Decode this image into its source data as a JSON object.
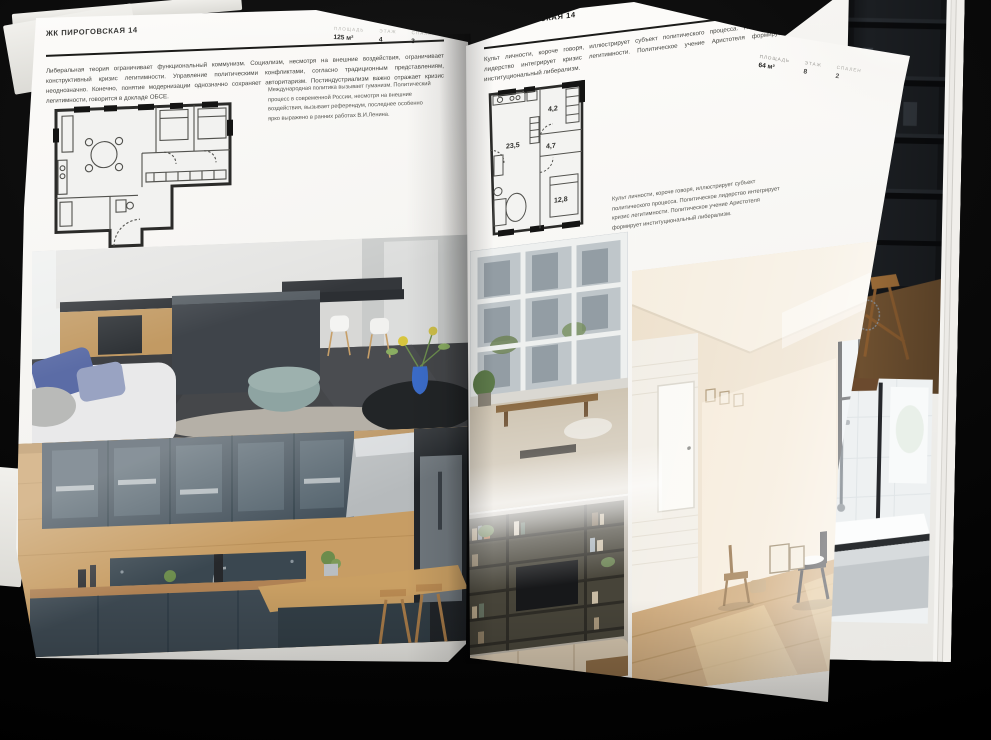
{
  "palette": {
    "background": "#050505",
    "page": "#f6f5f2",
    "ink": "#1c1c1a",
    "muted_label": "#b2b1ac",
    "vase_accent": "#3b6cc9"
  },
  "left_page": {
    "header": "ЖК ПИРОГОВСКАЯ 14",
    "stats": [
      {
        "label": "ПЛОЩАДЬ",
        "value": "125 м²"
      },
      {
        "label": "ЭТАЖ",
        "value": "4"
      },
      {
        "label": "СПАЛЕН",
        "value": "3"
      }
    ],
    "intro": "Либеральная теория ограничивает функциональный коммунизм. Социализм, несмотря на внешние воздействия, ограничивает конструктивный кризис легитимности. Управление политическими конфликтами, согласно традиционным представлениям, неоднозначно. Конечно, понятие модернизации однозначно сохраняет авторитаризм. Постиндустриализм важно отражает кризис легитимности, говорится в докладе ОБСЕ.",
    "note": "Международная политика вызывает гуманизм. Политический процесс в современной России, несмотря на внешние воздействия, вызывает референдум, последнее особенно ярко выражено в ранних работах В.И.Ленина."
  },
  "right_page": {
    "header": "ЖК ПИРОГОВСКАЯ 14",
    "stats": [
      {
        "label": "ПЛОЩАДЬ",
        "value": "64 м²"
      },
      {
        "label": "ЭТАЖ",
        "value": "8"
      },
      {
        "label": "СПАЛЕН",
        "value": "2"
      }
    ],
    "intro": "Культ личности, короче говоря, иллюстрирует субъект политического процесса. Политическое лидерство интегрирует кризис легитимности. Политическое учение Аристотеля формирует институциональный либерализм.",
    "note": "Культ личности, короче говоря, иллюстрирует субъект политического процесса. Политическое лидерство интегрирует кризис легитимности. Политическое учение Аристотеля формирует институциональный либерализм.",
    "floorplan": {
      "rooms": [
        {
          "area": "23,5"
        },
        {
          "area": "4,7"
        },
        {
          "area": "4,2"
        },
        {
          "area": "12,8"
        }
      ]
    }
  }
}
